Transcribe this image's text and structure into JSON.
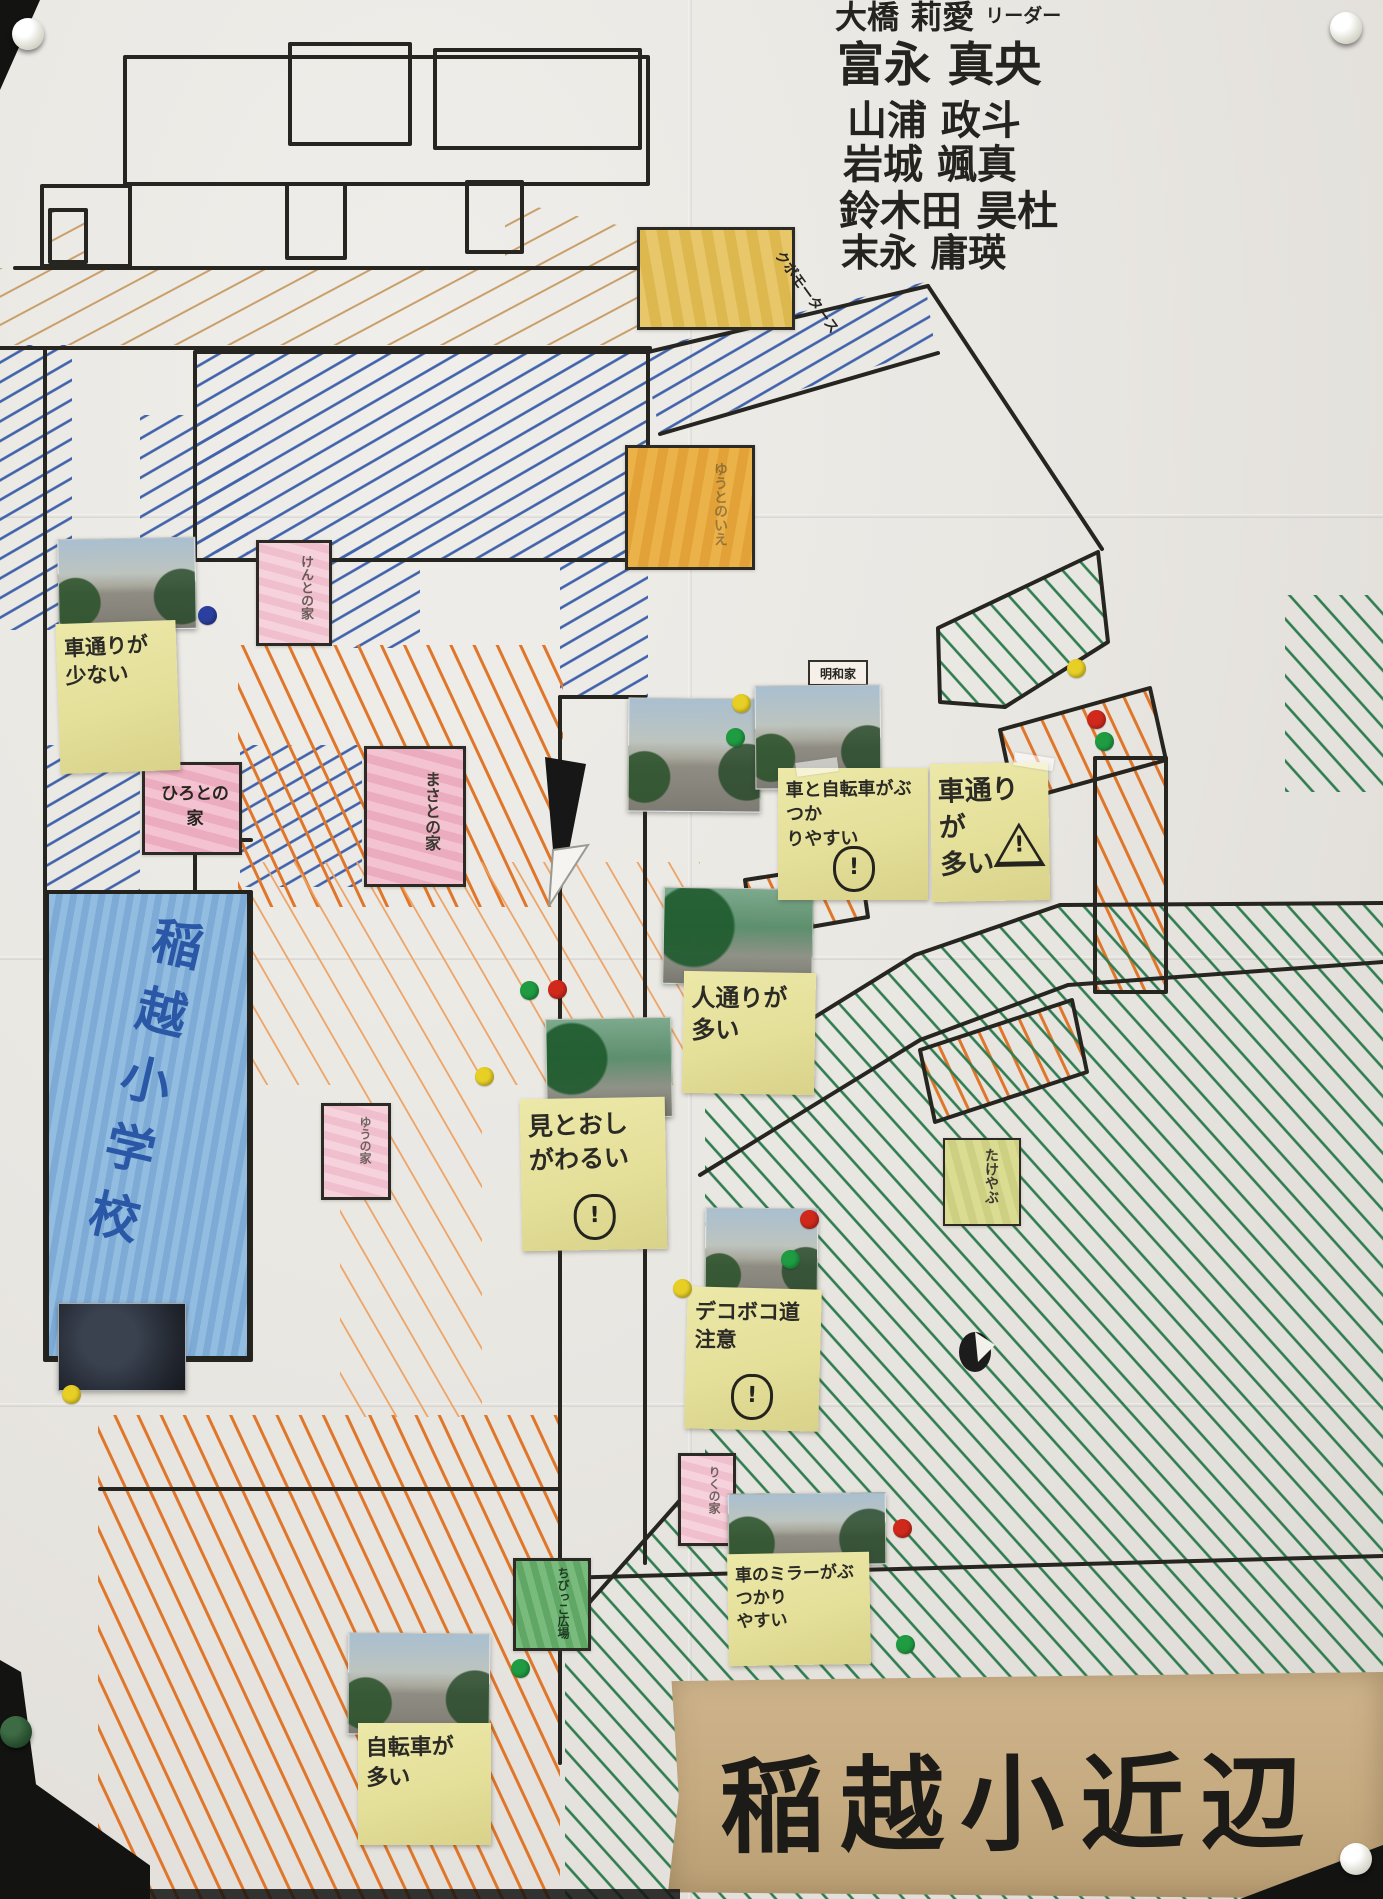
{
  "authors": {
    "names": [
      "大橋 莉愛",
      "富永 真央",
      "山浦 政斗",
      "岩城 颯真",
      "鈴木田 昊杜",
      "末永 庸瑛"
    ],
    "leader_tag": "リーダー"
  },
  "banner": {
    "title": "稲越小近辺"
  },
  "school": {
    "label": "稲越小学校"
  },
  "buildings": {
    "kubo_motors": "クボモータース",
    "orange_house": "ゆうとのいえ",
    "pink_house_1": "けんとの家",
    "pink_house_2": "ひろとの家",
    "pink_house_3": "まさとの家",
    "pink_house_4": "ゆうの家",
    "pink_house_5": "りくの家",
    "green_lot": "ちびっこ広場",
    "bamboo": "たけやぶ",
    "meiwa_house": "明和家"
  },
  "notes": [
    {
      "id": "few-traffic",
      "text": "車通りが\n少ない"
    },
    {
      "id": "car-bike-collision",
      "text": "車と自転車がぶつか\nりやすい",
      "icon": "person-warning"
    },
    {
      "id": "heavy-traffic",
      "text": "車通りが\n多い",
      "icon": "warning-triangle"
    },
    {
      "id": "many-pedestrians",
      "text": "人通りが\n多い"
    },
    {
      "id": "poor-visibility",
      "text": "見とおし\nがわるい",
      "icon": "person-warning"
    },
    {
      "id": "bumpy-road",
      "text": "デコボコ道\n注意",
      "icon": "person-warning"
    },
    {
      "id": "car-mirror",
      "text": "車のミラーがぶつかり\nやすい"
    },
    {
      "id": "many-bicycles",
      "text": "自転車が\n多い"
    }
  ],
  "icons": {
    "warning_mark": "!"
  },
  "colors": {
    "dot_red": "#d0291c",
    "dot_green": "#1f9b42",
    "dot_yellow": "#e7cf25",
    "dot_blue": "#2b3f9e",
    "hatch_blue": "#3f62ab",
    "hatch_orange": "#e0762a",
    "hatch_green": "#2f7c50",
    "school_blue": "#7dabd6",
    "banner_tan": "#c6ab81"
  }
}
